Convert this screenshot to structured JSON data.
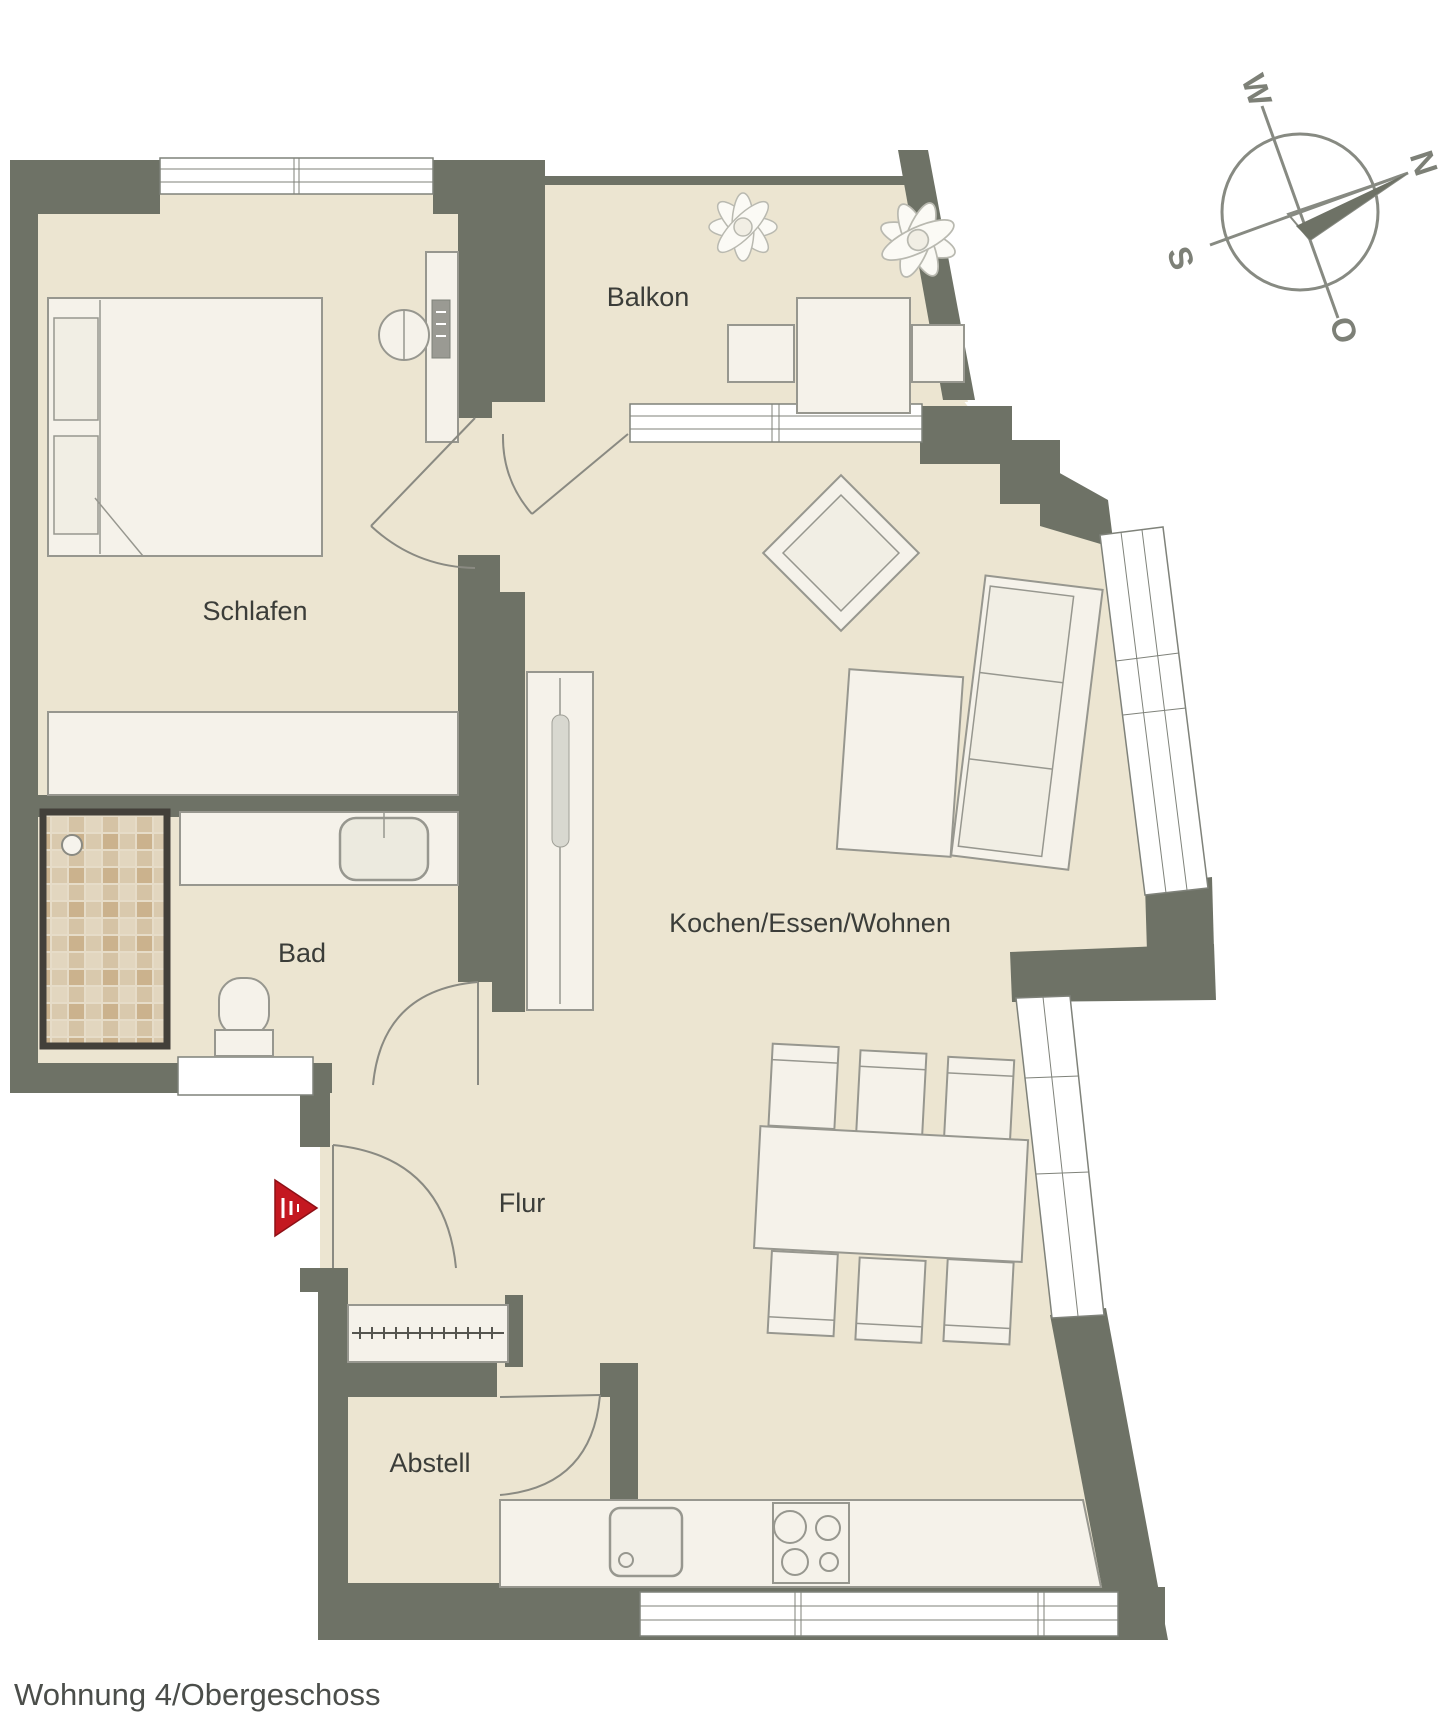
{
  "title": {
    "text": "Wohnung 4/Obergeschoss"
  },
  "rooms": {
    "schlafen": {
      "label": "Schlafen"
    },
    "balkon": {
      "label": "Balkon"
    },
    "bad": {
      "label": "Bad"
    },
    "flur": {
      "label": "Flur"
    },
    "abstell": {
      "label": "Abstell"
    },
    "wohnen": {
      "label": "Kochen/Essen/Wohnen"
    }
  },
  "compass": {
    "n": "N",
    "o": "O",
    "s": "S",
    "w": "W",
    "rotation_deg": 72
  },
  "colors": {
    "wall": "#6e7266",
    "floor": "#ece5d1",
    "furn": "#f5f2ea",
    "line": "#97978f",
    "line2": "#7f827a",
    "text": "#3b3d39",
    "text2": "#4b4e4a",
    "comp": "#7d8077",
    "red": "#c41820"
  }
}
